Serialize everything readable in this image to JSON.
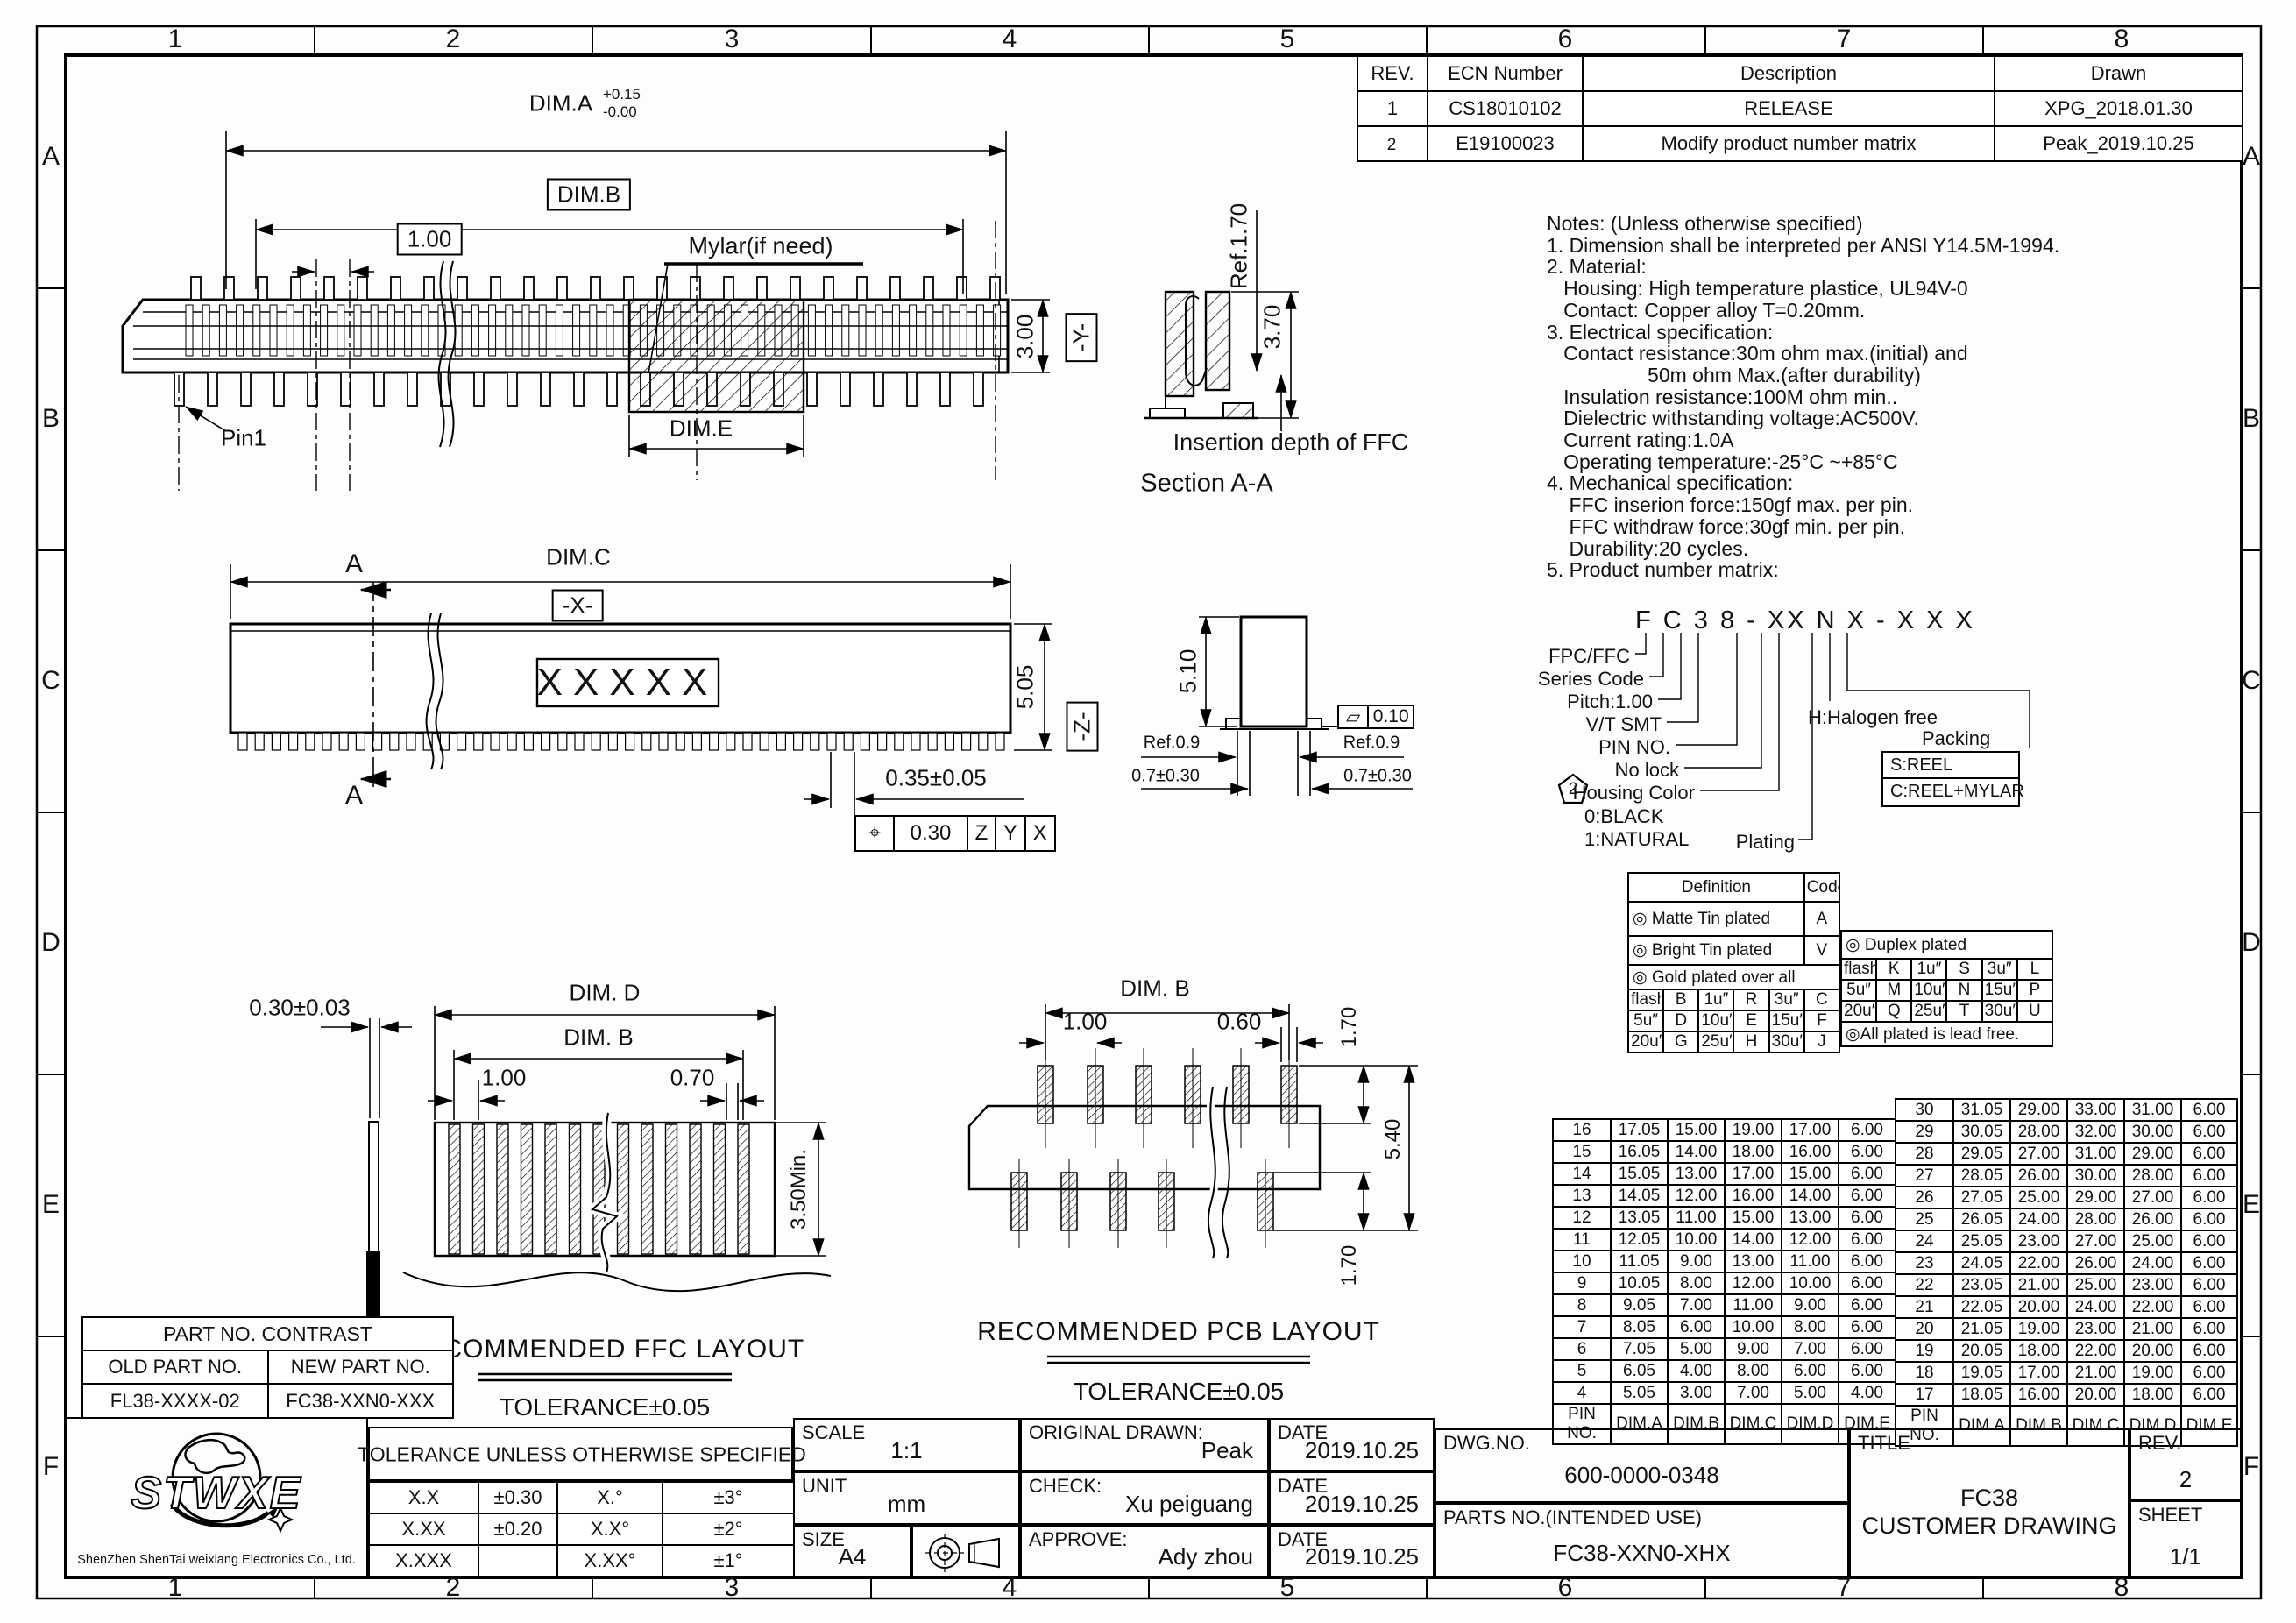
{
  "zones": {
    "cols": [
      "1",
      "2",
      "3",
      "4",
      "5",
      "6",
      "7",
      "8"
    ],
    "rows": [
      "A",
      "B",
      "C",
      "D",
      "E",
      "F"
    ]
  },
  "revision_table": {
    "headers": [
      "REV.",
      "ECN Number",
      "Description",
      "Drawn"
    ],
    "rows": [
      {
        "rev": "1",
        "ecn": "CS18010102",
        "desc": "RELEASE",
        "drawn": "XPG_2018.01.30"
      },
      {
        "rev": "2",
        "ecn": "E19100023",
        "desc": "Modify product number matrix",
        "drawn": "Peak_2019.10.25"
      }
    ]
  },
  "notes": [
    "Notes: (Unless otherwise specified)",
    "1. Dimension shall be interpreted per ANSI Y14.5M-1994.",
    "2. Material:",
    "   Housing: High temperature plastice, UL94V-0",
    "   Contact: Copper alloy T=0.20mm.",
    "3. Electrical specification:",
    "   Contact resistance:30m ohm max.(initial) and",
    "                  50m ohm Max.(after durability)",
    "   Insulation resistance:100M ohm min..",
    "   Dielectric withstanding voltage:AC500V.",
    "   Current rating:1.0A",
    "   Operating temperature:-25°C ~+85°C",
    "4. Mechanical specification:",
    "    FFC inserion force:150gf max. per pin.",
    "    FFC withdraw force:30gf min. per pin.",
    "    Durability:20 cycles.",
    "5. Product number matrix:"
  ],
  "matrix": {
    "code": "F C 3 8 - XX N X - X X X",
    "rev_mark": "2",
    "labels": {
      "fpc": "FPC/FFC",
      "series": "Series Code",
      "pitch": "Pitch:1.00",
      "vt": "V/T SMT",
      "pin": "PIN NO.",
      "lock": "No lock",
      "housing": "Housing Color",
      "housing0": "0:BLACK",
      "housing1": "1:NATURAL",
      "plating": "Plating",
      "halogen": "H:Halogen free",
      "packing": "Packing"
    },
    "packing_options": [
      "S:REEL",
      "C:REEL+MYLAR"
    ]
  },
  "plating": {
    "def_header": "Definition",
    "code_header": "Code",
    "matte": "◎ Matte Tin plated",
    "matte_code": "A",
    "bright": "◎ Bright Tin plated",
    "bright_code": "V",
    "gold": "◎ Gold plated over all",
    "gold_grid": [
      [
        "flash",
        "B",
        "1u″",
        "R",
        "3u″",
        "C"
      ],
      [
        "5u″",
        "D",
        "10u″",
        "E",
        "15u″",
        "F"
      ],
      [
        "20u″",
        "G",
        "25u″",
        "H",
        "30u″",
        "J"
      ]
    ],
    "duplex": "◎ Duplex plated",
    "duplex_grid": [
      [
        "flash",
        "K",
        "1u″",
        "S",
        "3u″",
        "L"
      ],
      [
        "5u″",
        "M",
        "10u″",
        "N",
        "15u″",
        "P"
      ],
      [
        "20u″",
        "Q",
        "25u″",
        "T",
        "30u″",
        "U"
      ]
    ],
    "lead_free": "◎All plated is lead free."
  },
  "pin_table": {
    "headers": [
      "PIN NO.",
      "DIM.A",
      "DIM.B",
      "DIM.C",
      "DIM.D",
      "DIM.E"
    ],
    "left": [
      [
        "16",
        "17.05",
        "15.00",
        "19.00",
        "17.00",
        "6.00"
      ],
      [
        "15",
        "16.05",
        "14.00",
        "18.00",
        "16.00",
        "6.00"
      ],
      [
        "14",
        "15.05",
        "13.00",
        "17.00",
        "15.00",
        "6.00"
      ],
      [
        "13",
        "14.05",
        "12.00",
        "16.00",
        "14.00",
        "6.00"
      ],
      [
        "12",
        "13.05",
        "11.00",
        "15.00",
        "13.00",
        "6.00"
      ],
      [
        "11",
        "12.05",
        "10.00",
        "14.00",
        "12.00",
        "6.00"
      ],
      [
        "10",
        "11.05",
        "9.00",
        "13.00",
        "11.00",
        "6.00"
      ],
      [
        "9",
        "10.05",
        "8.00",
        "12.00",
        "10.00",
        "6.00"
      ],
      [
        "8",
        "9.05",
        "7.00",
        "11.00",
        "9.00",
        "6.00"
      ],
      [
        "7",
        "8.05",
        "6.00",
        "10.00",
        "8.00",
        "6.00"
      ],
      [
        "6",
        "7.05",
        "5.00",
        "9.00",
        "7.00",
        "6.00"
      ],
      [
        "5",
        "6.05",
        "4.00",
        "8.00",
        "6.00",
        "6.00"
      ],
      [
        "4",
        "5.05",
        "3.00",
        "7.00",
        "5.00",
        "4.00"
      ]
    ],
    "right": [
      [
        "30",
        "31.05",
        "29.00",
        "33.00",
        "31.00",
        "6.00"
      ],
      [
        "29",
        "30.05",
        "28.00",
        "32.00",
        "30.00",
        "6.00"
      ],
      [
        "28",
        "29.05",
        "27.00",
        "31.00",
        "29.00",
        "6.00"
      ],
      [
        "27",
        "28.05",
        "26.00",
        "30.00",
        "28.00",
        "6.00"
      ],
      [
        "26",
        "27.05",
        "25.00",
        "29.00",
        "27.00",
        "6.00"
      ],
      [
        "25",
        "26.05",
        "24.00",
        "28.00",
        "26.00",
        "6.00"
      ],
      [
        "24",
        "25.05",
        "23.00",
        "27.00",
        "25.00",
        "6.00"
      ],
      [
        "23",
        "24.05",
        "22.00",
        "26.00",
        "24.00",
        "6.00"
      ],
      [
        "22",
        "23.05",
        "21.00",
        "25.00",
        "23.00",
        "6.00"
      ],
      [
        "21",
        "22.05",
        "20.00",
        "24.00",
        "22.00",
        "6.00"
      ],
      [
        "20",
        "21.05",
        "19.00",
        "23.00",
        "21.00",
        "6.00"
      ],
      [
        "19",
        "20.05",
        "18.00",
        "22.00",
        "20.00",
        "6.00"
      ],
      [
        "18",
        "19.05",
        "17.00",
        "21.00",
        "19.00",
        "6.00"
      ],
      [
        "17",
        "18.05",
        "16.00",
        "20.00",
        "18.00",
        "6.00"
      ]
    ]
  },
  "views": {
    "top": {
      "dim_a": "DIM.A",
      "dim_a_tol_plus": "+0.15",
      "dim_a_tol_minus": "-0.00",
      "dim_b": "DIM.B",
      "pitch": "1.00",
      "mylar": "Mylar(if need)",
      "pin1": "Pin1",
      "dim_e": "DIM.E",
      "height": "3.00",
      "datum_y": "-Y-"
    },
    "section": {
      "ref_depth": "Ref.1.70",
      "depth": "3.70",
      "insertion_label": "Insertion depth of FFC",
      "caption": "Section A-A"
    },
    "front": {
      "dim_c": "DIM.C",
      "datum_x": "-X-",
      "marking": "XXXXX",
      "height": "5.05",
      "datum_z": "-Z-",
      "contact_width": "0.35±0.05",
      "cut_label": "A",
      "gdt": {
        "sym": "⌖",
        "tol": "0.30",
        "d1": "Z",
        "d2": "Y",
        "d3": "X"
      }
    },
    "side": {
      "height": "5.10",
      "flat_sym": "▱",
      "flatness": "0.10",
      "ref_left": "Ref.0.9",
      "lead_left": "0.7±0.30",
      "ref_right": "Ref.0.9",
      "lead_right": "0.7±0.30"
    }
  },
  "ffc": {
    "thickness": "0.30±0.03",
    "dim_d": "DIM. D",
    "dim_b": "DIM. B",
    "pitch": "1.00",
    "width": "0.70",
    "min_len": "3.50Min.",
    "title": "RECOMMENDED FFC LAYOUT",
    "tolerance": "TOLERANCE±0.05"
  },
  "pcb": {
    "dim_b": "DIM. B",
    "pitch": "1.00",
    "pad_w": "0.60",
    "pad_h_top": "1.70",
    "span": "5.40",
    "pad_h_bottom": "1.70",
    "title": "RECOMMENDED PCB LAYOUT",
    "tolerance": "TOLERANCE±0.05"
  },
  "contrast": {
    "title": "PART NO. CONTRAST",
    "old_header": "OLD PART NO.",
    "new_header": "NEW PART NO.",
    "old_value": "FL38-XXXX-02",
    "new_value": "FC38-XXN0-XXX"
  },
  "company": {
    "logo": "STWXE",
    "name": "ShenZhen ShenTai weixiang Electronics Co., Ltd."
  },
  "tolerance_block": {
    "title": "TOLERANCE UNLESS OTHERWISE SPECIFIED",
    "rows": [
      [
        "X.X",
        "±0.30",
        "X.°",
        "±3°"
      ],
      [
        "X.XX",
        "±0.20",
        "X.X°",
        "±2°"
      ],
      [
        "X.XXX",
        "",
        "X.XX°",
        "±1°"
      ]
    ]
  },
  "title_block": {
    "scale_label": "SCALE",
    "scale": "1:1",
    "unit_label": "UNIT",
    "unit": "mm",
    "size_label": "SIZE",
    "size": "A4",
    "drawn_label": "ORIGINAL DRAWN:",
    "drawn": "Peak",
    "check_label": "CHECK:",
    "check": "Xu peiguang",
    "approve_label": "APPROVE:",
    "approve": "Ady zhou",
    "date_label": "DATE",
    "date1": "2019.10.25",
    "date2": "2019.10.25",
    "date3": "2019.10.25",
    "dwg_label": "DWG.NO.",
    "dwg": "600-0000-0348",
    "parts_label": "PARTS NO.(INTENDED USE)",
    "parts": "FC38-XXN0-XHX",
    "title_label": "TITLE",
    "title_line1": "FC38",
    "title_line2": "CUSTOMER DRAWING",
    "rev_label": "REV.",
    "rev": "2",
    "sheet_label": "SHEET",
    "sheet": "1/1"
  }
}
